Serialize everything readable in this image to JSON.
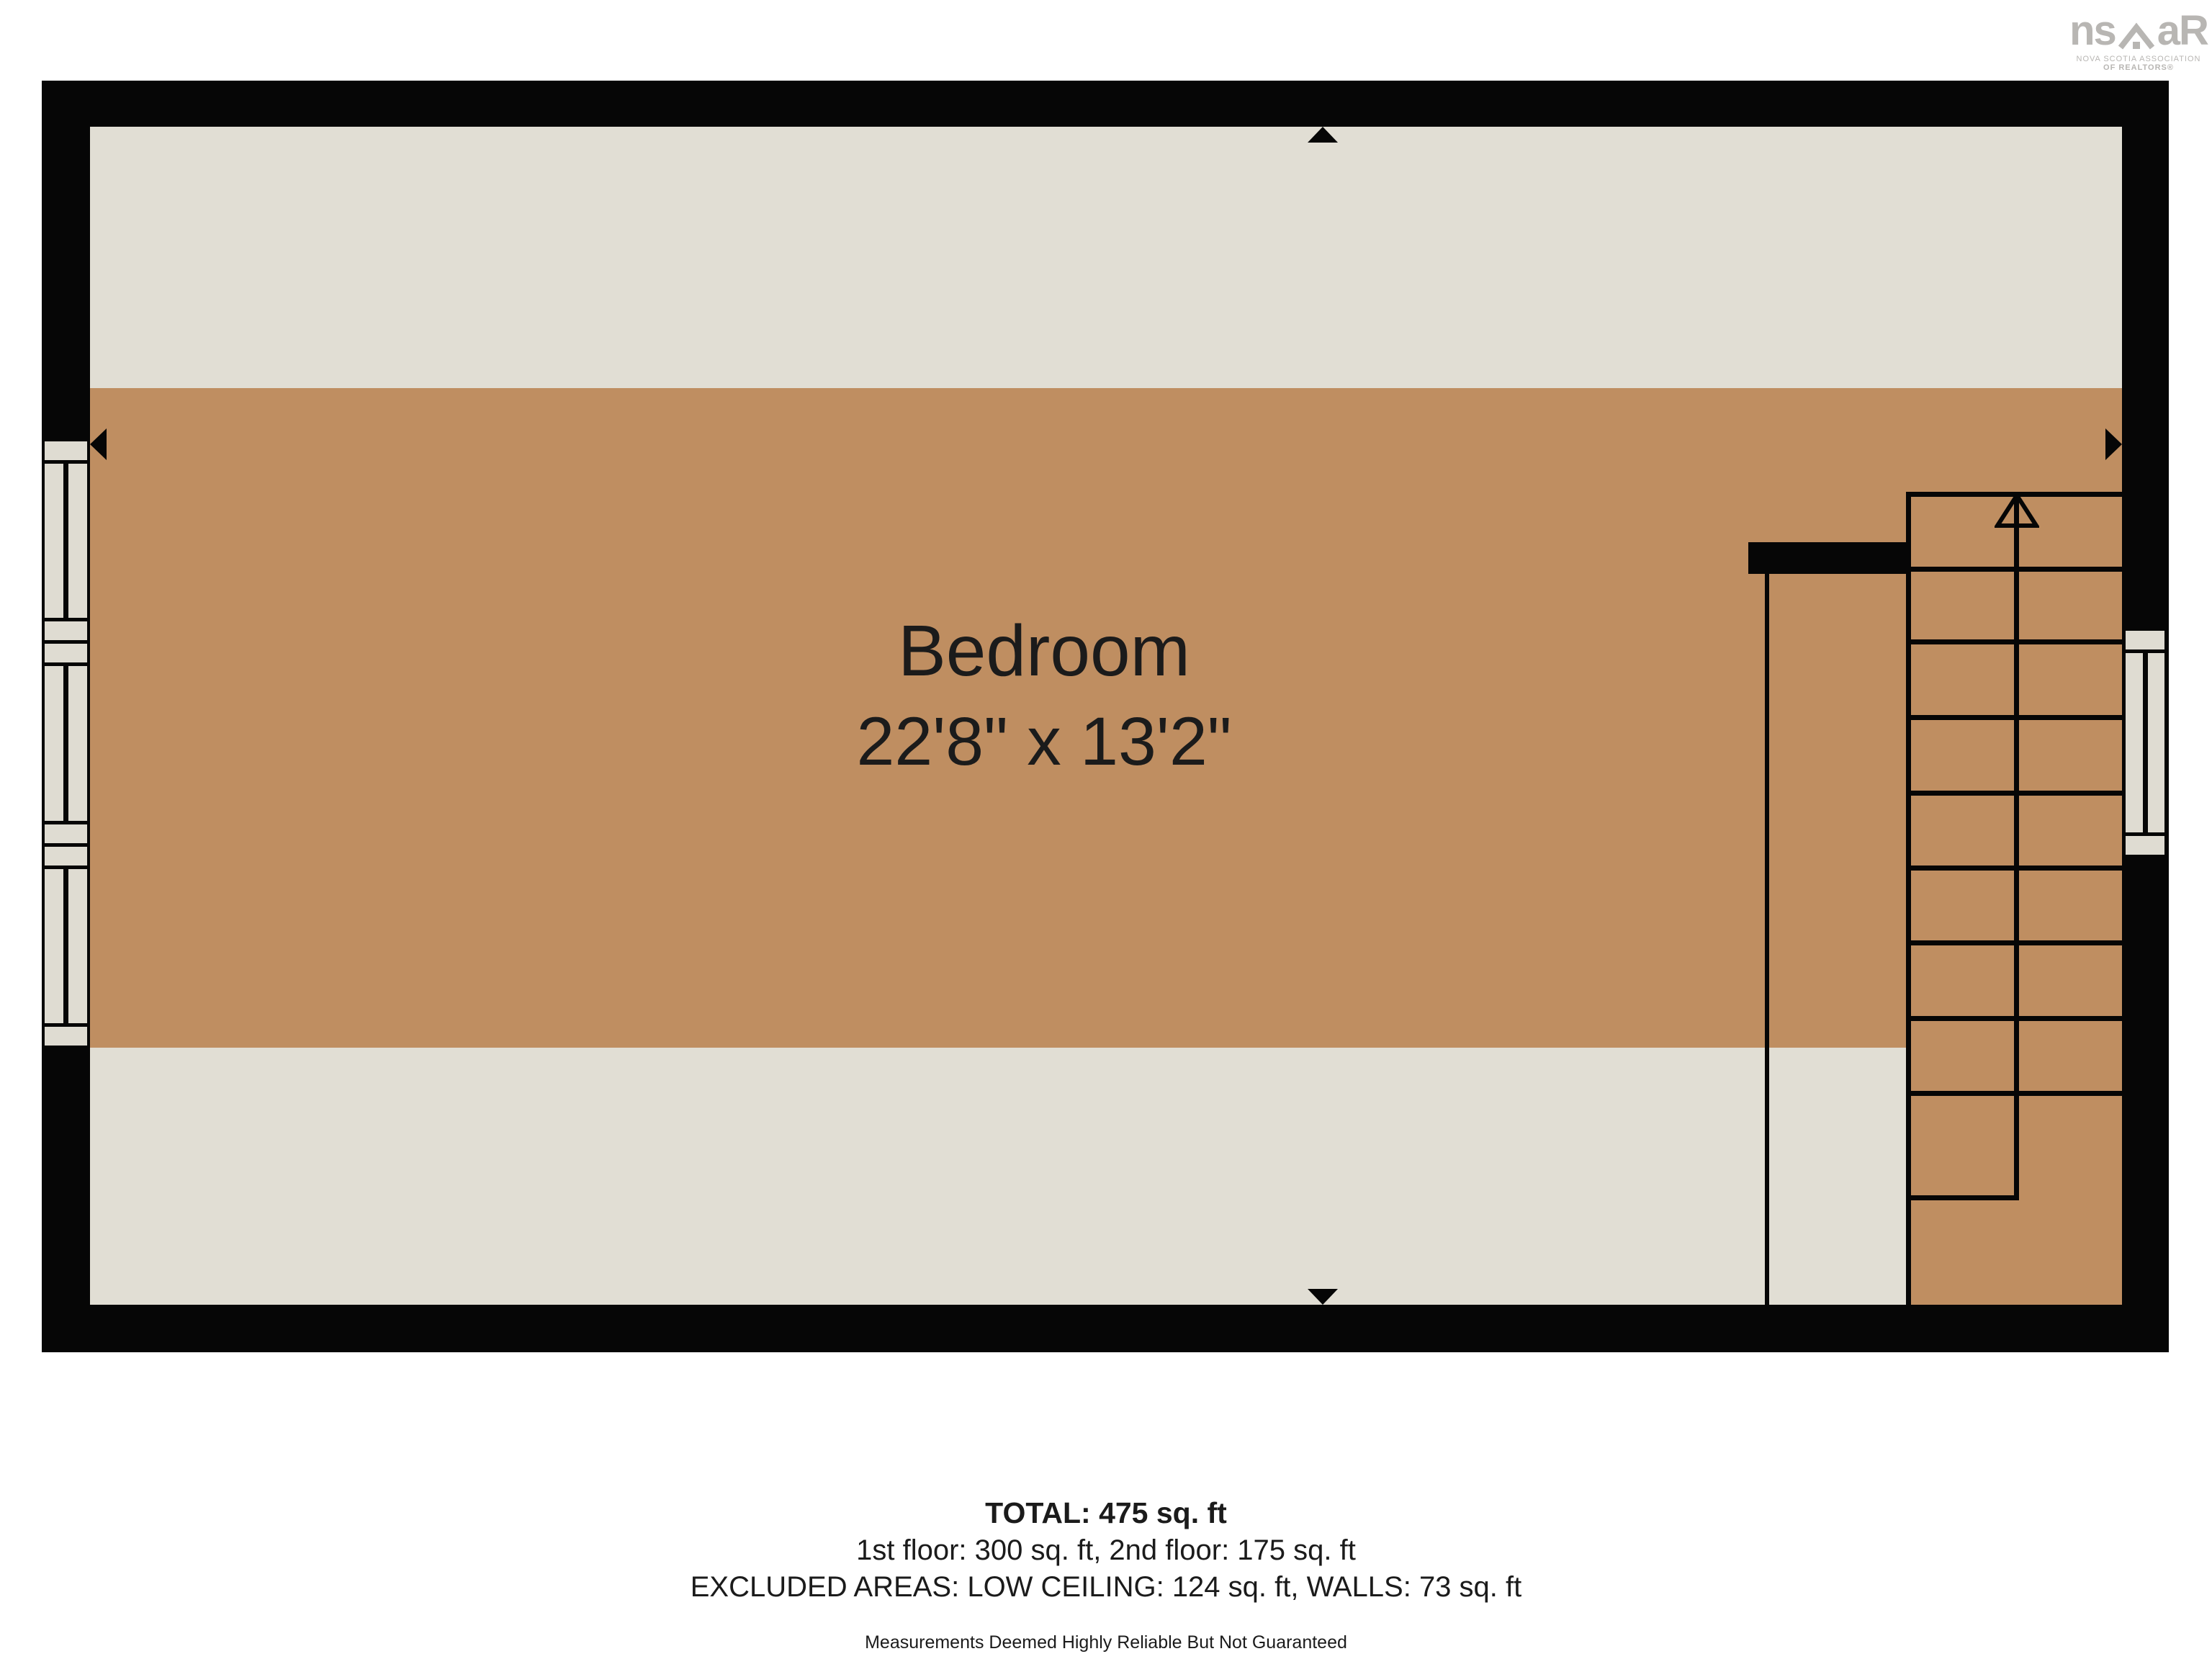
{
  "logo": {
    "text_left": "ns",
    "text_right": "aR",
    "tagline_line1": "NOVA SCOTIA ASSOCIATION",
    "tagline_line2": "OF REALTORS®"
  },
  "floor_plan": {
    "room_label": "Bedroom",
    "room_dimensions": "22'8\" x 13'2\""
  },
  "summary": {
    "total": "TOTAL: 475 sq. ft",
    "floors": "1st floor: 300 sq. ft, 2nd floor: 175 sq. ft",
    "excluded": "EXCLUDED AREAS: LOW CEILING: 124 sq. ft, WALLS: 73 sq. ft",
    "disclaimer": "Measurements Deemed Highly Reliable But Not Guaranteed"
  },
  "colors": {
    "wall": "#060606",
    "floor_main": "#bf8e61",
    "floor_low": "#e1ded4",
    "window_fill": "#dfdcd2",
    "logo_gray": "#b8b6b3",
    "text_dark": "#1b1b1b"
  }
}
